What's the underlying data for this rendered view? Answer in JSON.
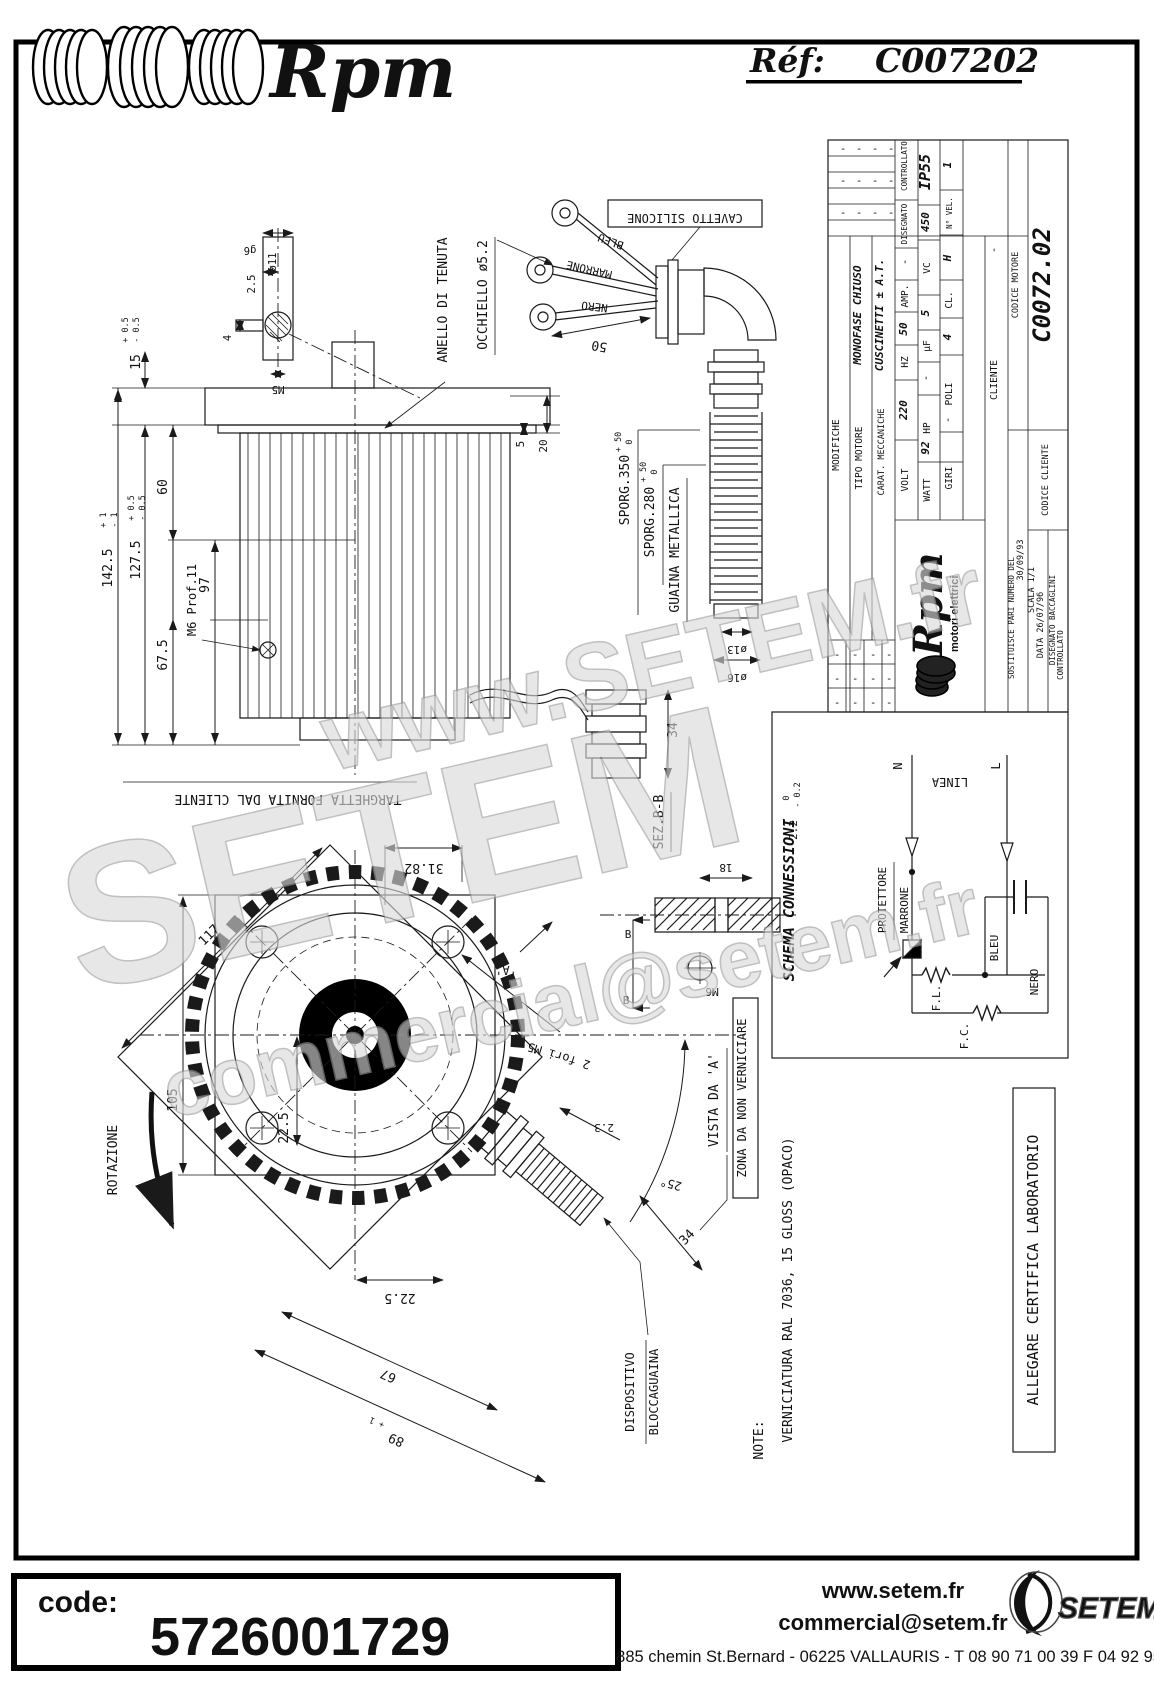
{
  "colors": {
    "ink": "#111111",
    "paper": "#ffffff",
    "watermark": "#d9d9d9"
  },
  "header": {
    "brand": "Rpm",
    "ref_label": "Réf:",
    "ref_value": "C007202"
  },
  "tb": {
    "modifiche": "MODIFICHE",
    "ind": "IND",
    "data": "DATA",
    "dash": "-",
    "disegnato": "DISEGNATO",
    "controllato": "CONTROLLATO",
    "ip": "IP55",
    "tipo_label": "TIPO MOTORE",
    "tipo": "MONOFASE CHIUSO",
    "carat_label": "CARAT. MECCANICHE",
    "carat": "CUSCINETTI ± A.T.",
    "volt_label": "VOLT",
    "volt": "220",
    "hz_label": "HZ",
    "hz": "50",
    "amp_label": "AMP.",
    "watt_label": "WATT",
    "watt": "92",
    "hp_label": "HP",
    "uf_label": "µF",
    "uf": "5",
    "vc_label": "VC",
    "vc": "450",
    "giri_label": "GIRI",
    "poli_label": "POLI",
    "poli": "4",
    "cl_label": "CL.",
    "cl": "H",
    "nvel_label": "N° VEL.",
    "nvel": "1",
    "cliente": "CLIENTE",
    "codmot_label": "CODICE MOTORE",
    "codmot": "C0072.02",
    "codcli_label": "CODICE CLIENTE",
    "sost": "SOSTITUISCE PARI NUMERO DEL",
    "sost_date": "30/09/93",
    "data_row": "DATA  26/07/96",
    "scala_row": "SCALA  1/1",
    "dis_row": "DISEGNATO  BACCAGLINI",
    "ctrl_row": "CONTROLLATO",
    "logo_name": "Rpm",
    "logo_sub": "motori elettrici"
  },
  "schema": {
    "title": "SCHEMA CONNESSIONI",
    "linea": "LINEA",
    "n": "N",
    "l": "L",
    "protettore": "PROTETTORE",
    "marrone": "MARRONE",
    "fl": "F.L.",
    "fc": "F.C.",
    "bleu": "BLEU",
    "nero": "NERO"
  },
  "sv": {
    "anello": "ANELLO DI TENUTA",
    "occhiello": "OCCHIELLO  ø5.2",
    "cavetto": "CAVETTO SILICONE",
    "bleu": "BLEU",
    "marrone": "MARRONE",
    "nero": "NERO",
    "d50": "50",
    "d5": "5",
    "d20": "20",
    "sporg350": "SPORG.350",
    "sporg280": "SPORG.280",
    "tol_p50": "+ 50",
    "tol_0": "0",
    "guaina": "GUAINA METALLICA",
    "d13": "ø13",
    "d16": "ø16",
    "d34": "34",
    "sez": "SEZ.B-B",
    "d18": "18",
    "d22": "2.2",
    "tol_m02": "- 0.2",
    "m6": "M6",
    "b": "B",
    "d1425": "142.5",
    "tp1": "+ 1",
    "tm1": "- 1",
    "d1275": "127.5",
    "tp05": "+ 0.5",
    "tm05": "- 0.5",
    "d15": "15",
    "d675": "67.5",
    "d60": "60",
    "d97": "97",
    "m6prof": "M6 Prof.11",
    "d4": "4",
    "d25": "2.5",
    "d11": "ø11",
    "g6": "g6",
    "m5": "M5",
    "targhetta": "TARGHETTA FORNITA DAL CLIENTE"
  },
  "fv": {
    "rotazione": "ROTAZIONE",
    "d117": "117",
    "d105": "105",
    "d225": "22.5",
    "d225b": "22.5",
    "d3182": "31.82",
    "fori": "2 fori M5",
    "d23": "2.3",
    "deg25": "25°",
    "a": "'A'",
    "vista": "VISTA DA 'A'",
    "zona": "ZONA DA NON VERNICIARE",
    "disp1": "DISPOSITIVO",
    "disp2": "BLOCCAGUAINA",
    "d34": "34",
    "d67": "67",
    "d89": "89",
    "tp1": "+ 1"
  },
  "note": {
    "label": "NOTE:",
    "text": "VERNICIATURA RAL 7036, 15 GLOSS (OPACO)"
  },
  "allegare": "ALLEGARE CERTIFICA LABORATORIO",
  "wm": {
    "top": "www.SETEM.fr",
    "mid": "SETEM",
    "bottom": "commercial@setem.fr"
  },
  "footer": {
    "code_label": "code:",
    "code": "5726001729",
    "site": "www.setem.fr",
    "email": "commercial@setem.fr",
    "address": "885 chemin St.Bernard  -  06225 VALLAURIS  -  T 08 90 71 00 39   F 04 92 95 19 39",
    "logo": "SETEM"
  }
}
